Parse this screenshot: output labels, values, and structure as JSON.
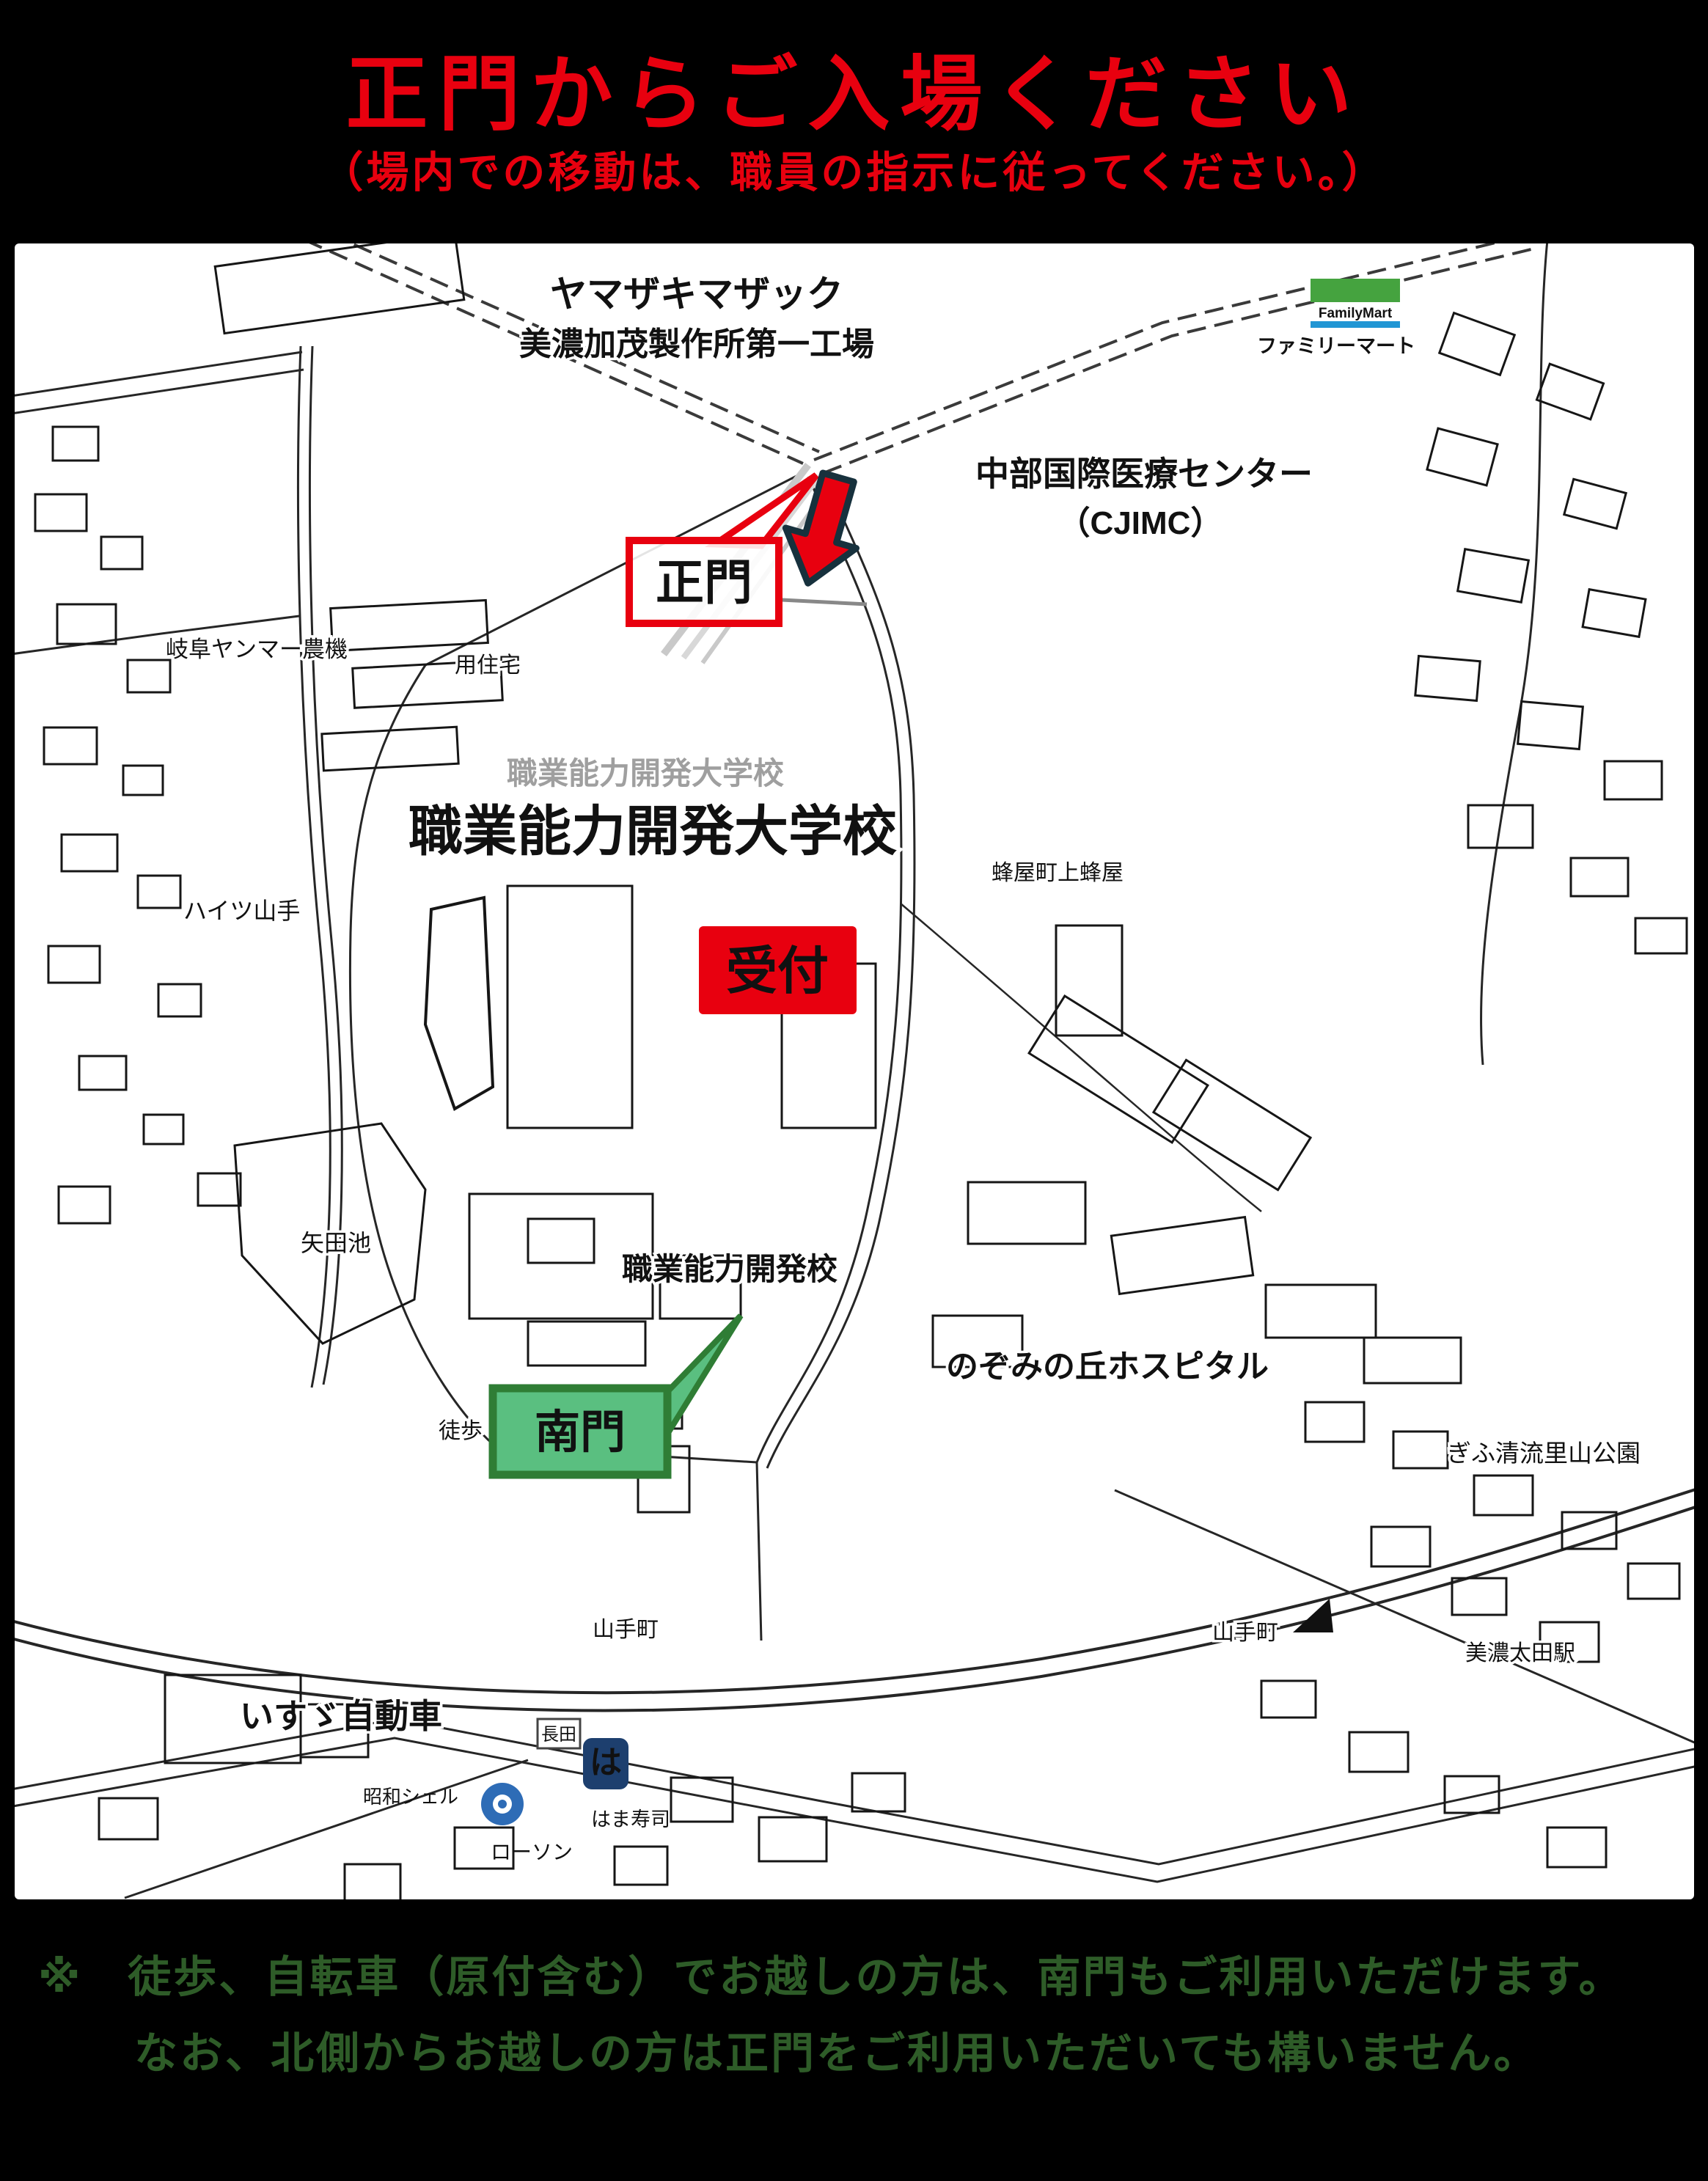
{
  "title": {
    "text": "正門からご入場ください",
    "subtitle": "（場内での移動は、職員の指示に従ってください。）"
  },
  "map": {
    "yamazaki_1": "ヤマザキマザック",
    "yamazaki_2": "美濃加茂製作所第一工場",
    "familymart_logo_text": "FamilyMart",
    "familymart": "ファミリーマート",
    "cjimc_1": "中部国際医療センター",
    "cjimc_2": "（CJIMC）",
    "main_gate": "正門",
    "yanmar": "岐阜ヤンマー農機",
    "jutaku": "用住宅",
    "college_ghost": "職業能力開発大学校",
    "college_blue": "職業能力開発大学校",
    "hachiya": "蜂屋町上蜂屋",
    "heights_yamate": "ハイツ山手",
    "yada_pond": "矢田池",
    "kaihatsu_ko": "職業能力開発校",
    "reception": "受付",
    "south_gate": "南門",
    "nozomi_hospital": "のぞみの丘ホスピタル",
    "walk_bike_entrance": "徒歩・自転車出入口",
    "yamate_cho": "山手町",
    "satoyama_park": "ぎふ清流里山公園",
    "mino_ota": "美濃太田駅",
    "isuzu": "いすゞ自動車",
    "nagata": "長田",
    "showa_shell": "昭和シェル",
    "lawson": "ローソン",
    "hamasushi_mark": "は",
    "hamasushi": "はま寿司"
  },
  "footer": {
    "line1": "※　徒歩、自転車（原付含む）でお越しの方は、南門もご利用いただけます。",
    "line2": "なお、北側からお越しの方は正門をご利用いただいても構いません。"
  },
  "colors": {
    "accent_red": "#e8000f",
    "map_blue": "#1a7cc9",
    "gate_green_fill": "#5abf80",
    "gate_green_border": "#2f7d35",
    "arrow_outline": "#17313d",
    "footer_green": "#2e5c28",
    "familymart_green": "#45a33f",
    "familymart_blue": "#2196d4",
    "lawson_blue": "#2e6cb6",
    "hamasushi_navy": "#1d3f6e"
  }
}
